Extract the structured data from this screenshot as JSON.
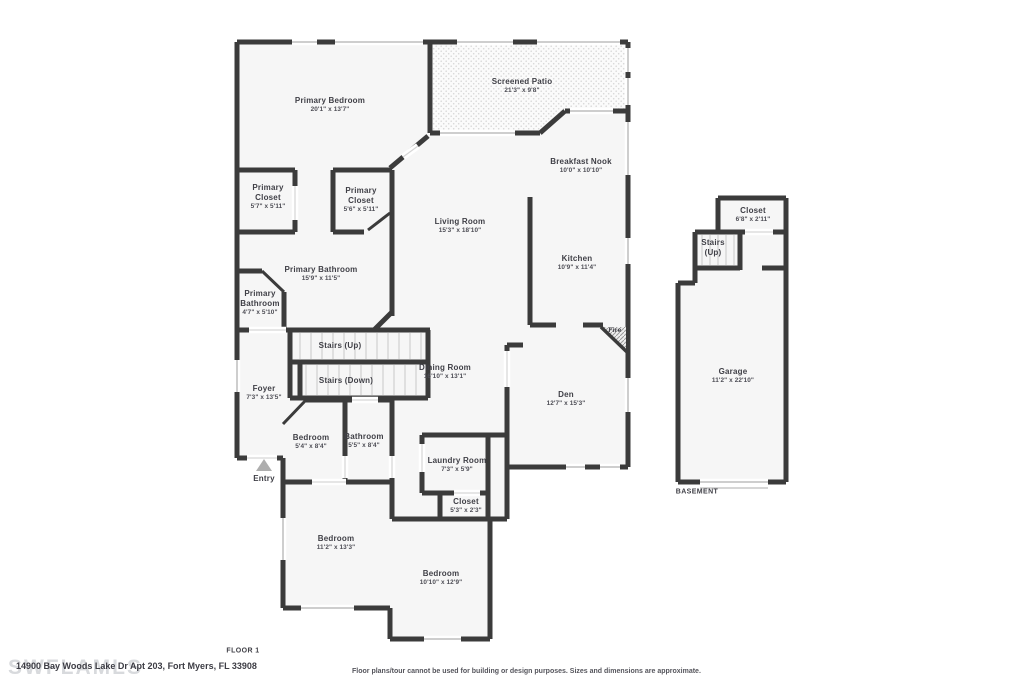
{
  "floor1": {
    "caption": "FLOOR 1",
    "rooms": [
      {
        "name": "Primary Bedroom",
        "dims": "20'1\" x 13'7\"",
        "x": 330,
        "y": 105
      },
      {
        "name": "Screened Patio",
        "dims": "21'3\" x 9'8\"",
        "x": 522,
        "y": 86
      },
      {
        "name": "Breakfast Nook",
        "dims": "10'0\" x 10'10\"",
        "x": 581,
        "y": 166
      },
      {
        "name": "Primary Closet",
        "dims": "5'7\" x 5'11\"",
        "x": 268,
        "y": 197,
        "w": 54
      },
      {
        "name": "Primary Closet",
        "dims": "5'6\" x 5'11\"",
        "x": 361,
        "y": 200,
        "w": 54
      },
      {
        "name": "Living Room",
        "dims": "15'3\" x 18'10\"",
        "x": 460,
        "y": 226
      },
      {
        "name": "Kitchen",
        "dims": "10'9\" x 11'4\"",
        "x": 577,
        "y": 263
      },
      {
        "name": "Primary Bathroom",
        "dims": "15'9\" x 11'5\"",
        "x": 321,
        "y": 274
      },
      {
        "name": "Primary Bathroom",
        "dims": "4'7\" x 5'10\"",
        "x": 260,
        "y": 303,
        "w": 62
      },
      {
        "name": "Stairs (Up)",
        "x": 340,
        "y": 346
      },
      {
        "name": "Stairs (Down)",
        "x": 346,
        "y": 381
      },
      {
        "name": "Foyer",
        "dims": "7'3\" x 13'5\"",
        "x": 264,
        "y": 393
      },
      {
        "name": "Dining Room",
        "dims": "16'10\" x 13'1\"",
        "x": 445,
        "y": 372
      },
      {
        "name": "Fire",
        "x": 615,
        "y": 331,
        "small": true
      },
      {
        "name": "Den",
        "dims": "12'7\" x 15'3\"",
        "x": 566,
        "y": 399
      },
      {
        "name": "Bedroom",
        "dims": "5'4\" x 8'4\"",
        "x": 311,
        "y": 442
      },
      {
        "name": "Bathroom",
        "dims": "5'5\" x 8'4\"",
        "x": 364,
        "y": 441
      },
      {
        "name": "Laundry Room",
        "dims": "7'3\" x 5'9\"",
        "x": 457,
        "y": 465
      },
      {
        "name": "Closet",
        "dims": "5'3\" x 2'3\"",
        "x": 466,
        "y": 506
      },
      {
        "name": "Bedroom",
        "dims": "11'2\" x 13'3\"",
        "x": 336,
        "y": 543
      },
      {
        "name": "Bedroom",
        "dims": "10'10\" x 12'9\"",
        "x": 441,
        "y": 578
      },
      {
        "name": "Entry",
        "x": 264,
        "y": 479
      }
    ]
  },
  "basement": {
    "caption": "BASEMENT",
    "rooms": [
      {
        "name": "Closet",
        "dims": "6'8\" x 2'11\"",
        "x": 753,
        "y": 215
      },
      {
        "name": "Stairs (Up)",
        "x": 713,
        "y": 248,
        "w": 42
      },
      {
        "name": "Garage",
        "dims": "11'2\" x 22'10\"",
        "x": 733,
        "y": 376
      }
    ]
  },
  "footer": {
    "address": "14900 Bay Woods Lake Dr Apt 203, Fort Myers, FL 33908",
    "disclaimer": "Floor plans/tour cannot be used for building or design purposes. Sizes and dimensions are approximate.",
    "watermark": "SWFLAMLS"
  },
  "colors": {
    "wall": "#3b3b3b",
    "room_fill": "#f6f6f6",
    "window": "#bdbdbd",
    "door": "#d6d6d6",
    "text": "#3f3f46"
  }
}
